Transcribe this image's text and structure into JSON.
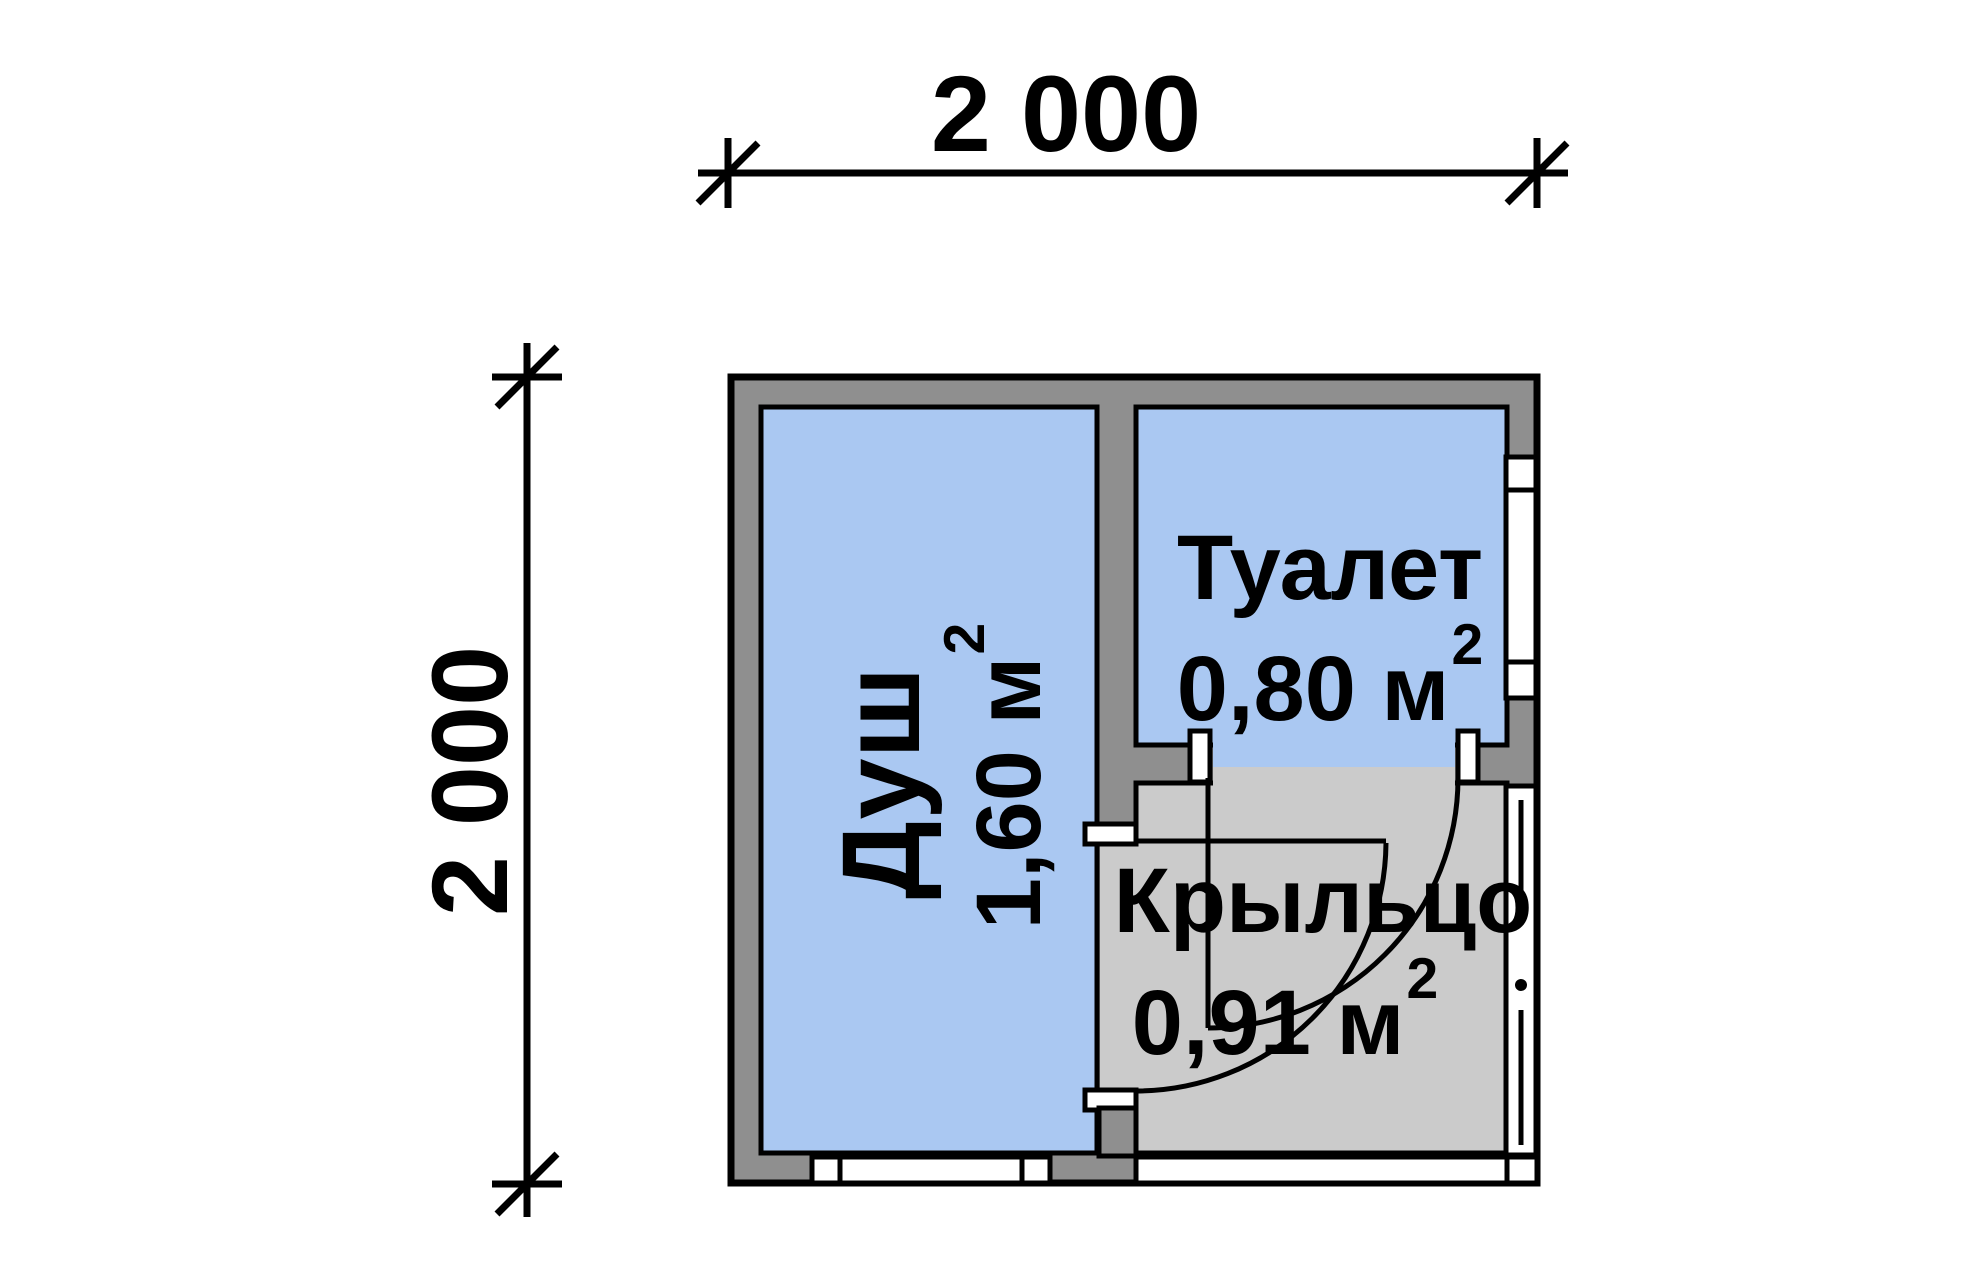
{
  "dimensions": {
    "top_label": "2 000",
    "left_label": "2 000"
  },
  "rooms": [
    {
      "id": "shower",
      "name": "Душ",
      "area_value": "1,60 м",
      "area_sup": "2"
    },
    {
      "id": "toilet",
      "name": "Туалет",
      "area_value": "0,80 м",
      "area_sup": "2"
    },
    {
      "id": "porch",
      "name": "Крыльцо",
      "area_value": "0,91 м",
      "area_sup": "2"
    }
  ],
  "colors": {
    "room_fill": "#aac8f2",
    "porch_fill": "#cbcbcb",
    "wall_fill": "#8f8f8f",
    "line": "#000000",
    "background": "#ffffff"
  }
}
